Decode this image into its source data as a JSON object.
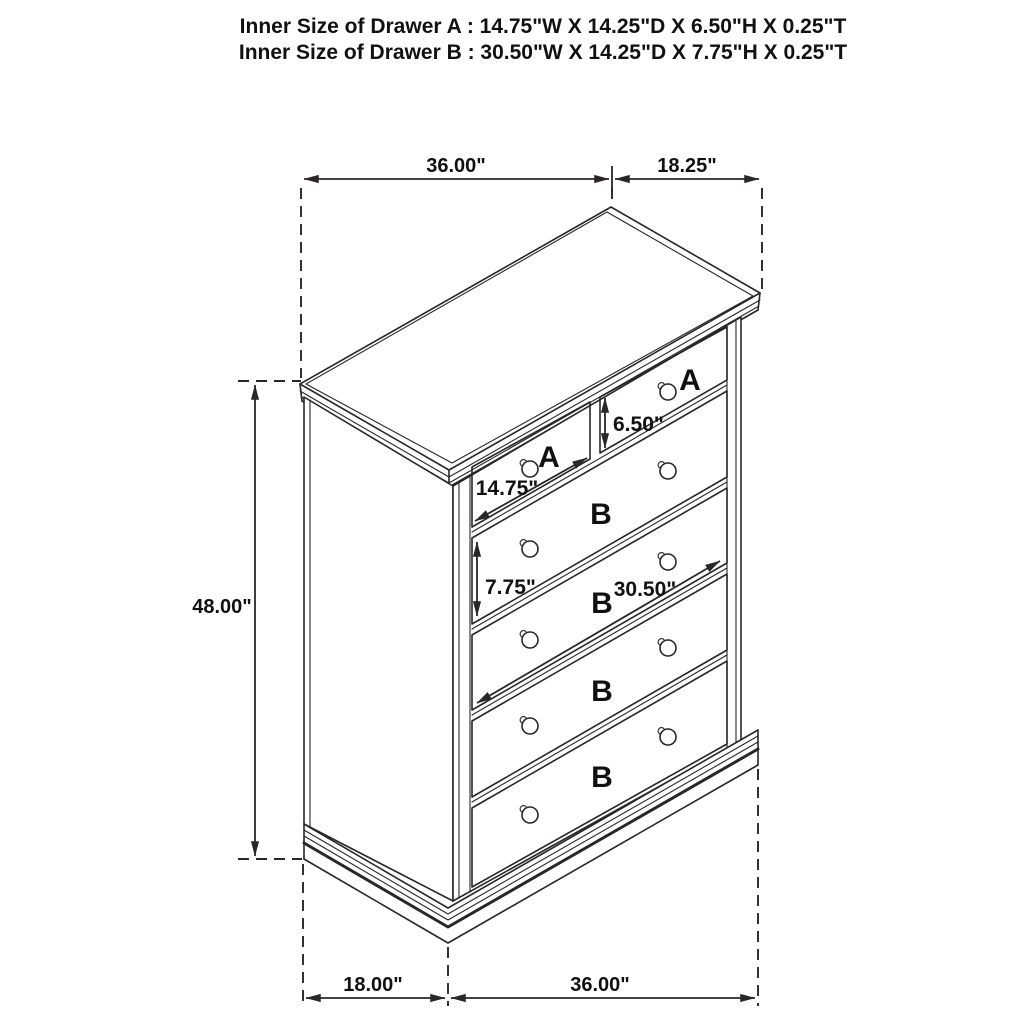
{
  "title": {
    "line1": "Inner Size of Drawer A : 14.75\"W X 14.25\"D X 6.50\"H X 0.25\"T",
    "line2": "Inner Size of Drawer B : 30.50\"W X 14.25\"D X 7.75\"H X 0.25\"T"
  },
  "dimensions": {
    "top_width": "36.00\"",
    "top_depth": "18.25\"",
    "height": "48.00\"",
    "bottom_depth": "18.00\"",
    "bottom_width": "36.00\"",
    "drawer_a_width": "14.75\"",
    "drawer_a_height": "6.50\"",
    "drawer_b_height": "7.75\"",
    "drawer_b_width": "30.50\""
  },
  "labels": {
    "drawer_a": "A",
    "drawer_b": "B"
  },
  "colors": {
    "line": "#2a2627",
    "label_red": "#e8201e",
    "background": "#ffffff"
  }
}
